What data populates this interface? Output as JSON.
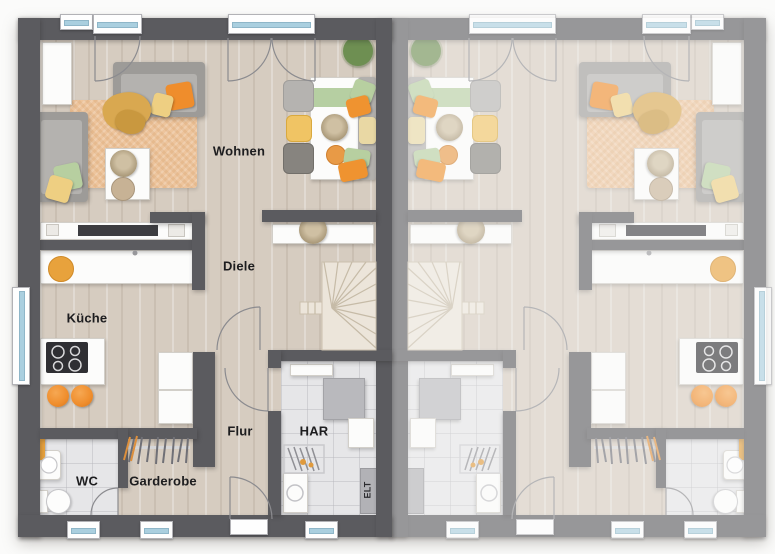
{
  "plan": {
    "kind": "duplex-ground-floor-plan",
    "rooms": [
      {
        "label": "Wohnen"
      },
      {
        "label": "Diele"
      },
      {
        "label": "Küche"
      },
      {
        "label": "Flur"
      },
      {
        "label": "HAR"
      },
      {
        "label": "WC"
      },
      {
        "label": "Garderobe"
      },
      {
        "label": "ELT"
      }
    ],
    "units": {
      "left": "furnished, labeled, full color",
      "right": "mirror image, faded / unlabeled"
    },
    "colors": {
      "wall_dark": "#5b5b5f",
      "wall_faded": "#a5a5a8",
      "wood_floor": "#d6ccc0",
      "tile_floor": "#e6e6e8",
      "rug": "#edc49c",
      "stairs": "#ece5da",
      "accent_orange": "#ef8d2c",
      "accent_yellow": "#eecf82",
      "accent_green": "#b7cfa0",
      "glass": "#aacfdf"
    }
  }
}
